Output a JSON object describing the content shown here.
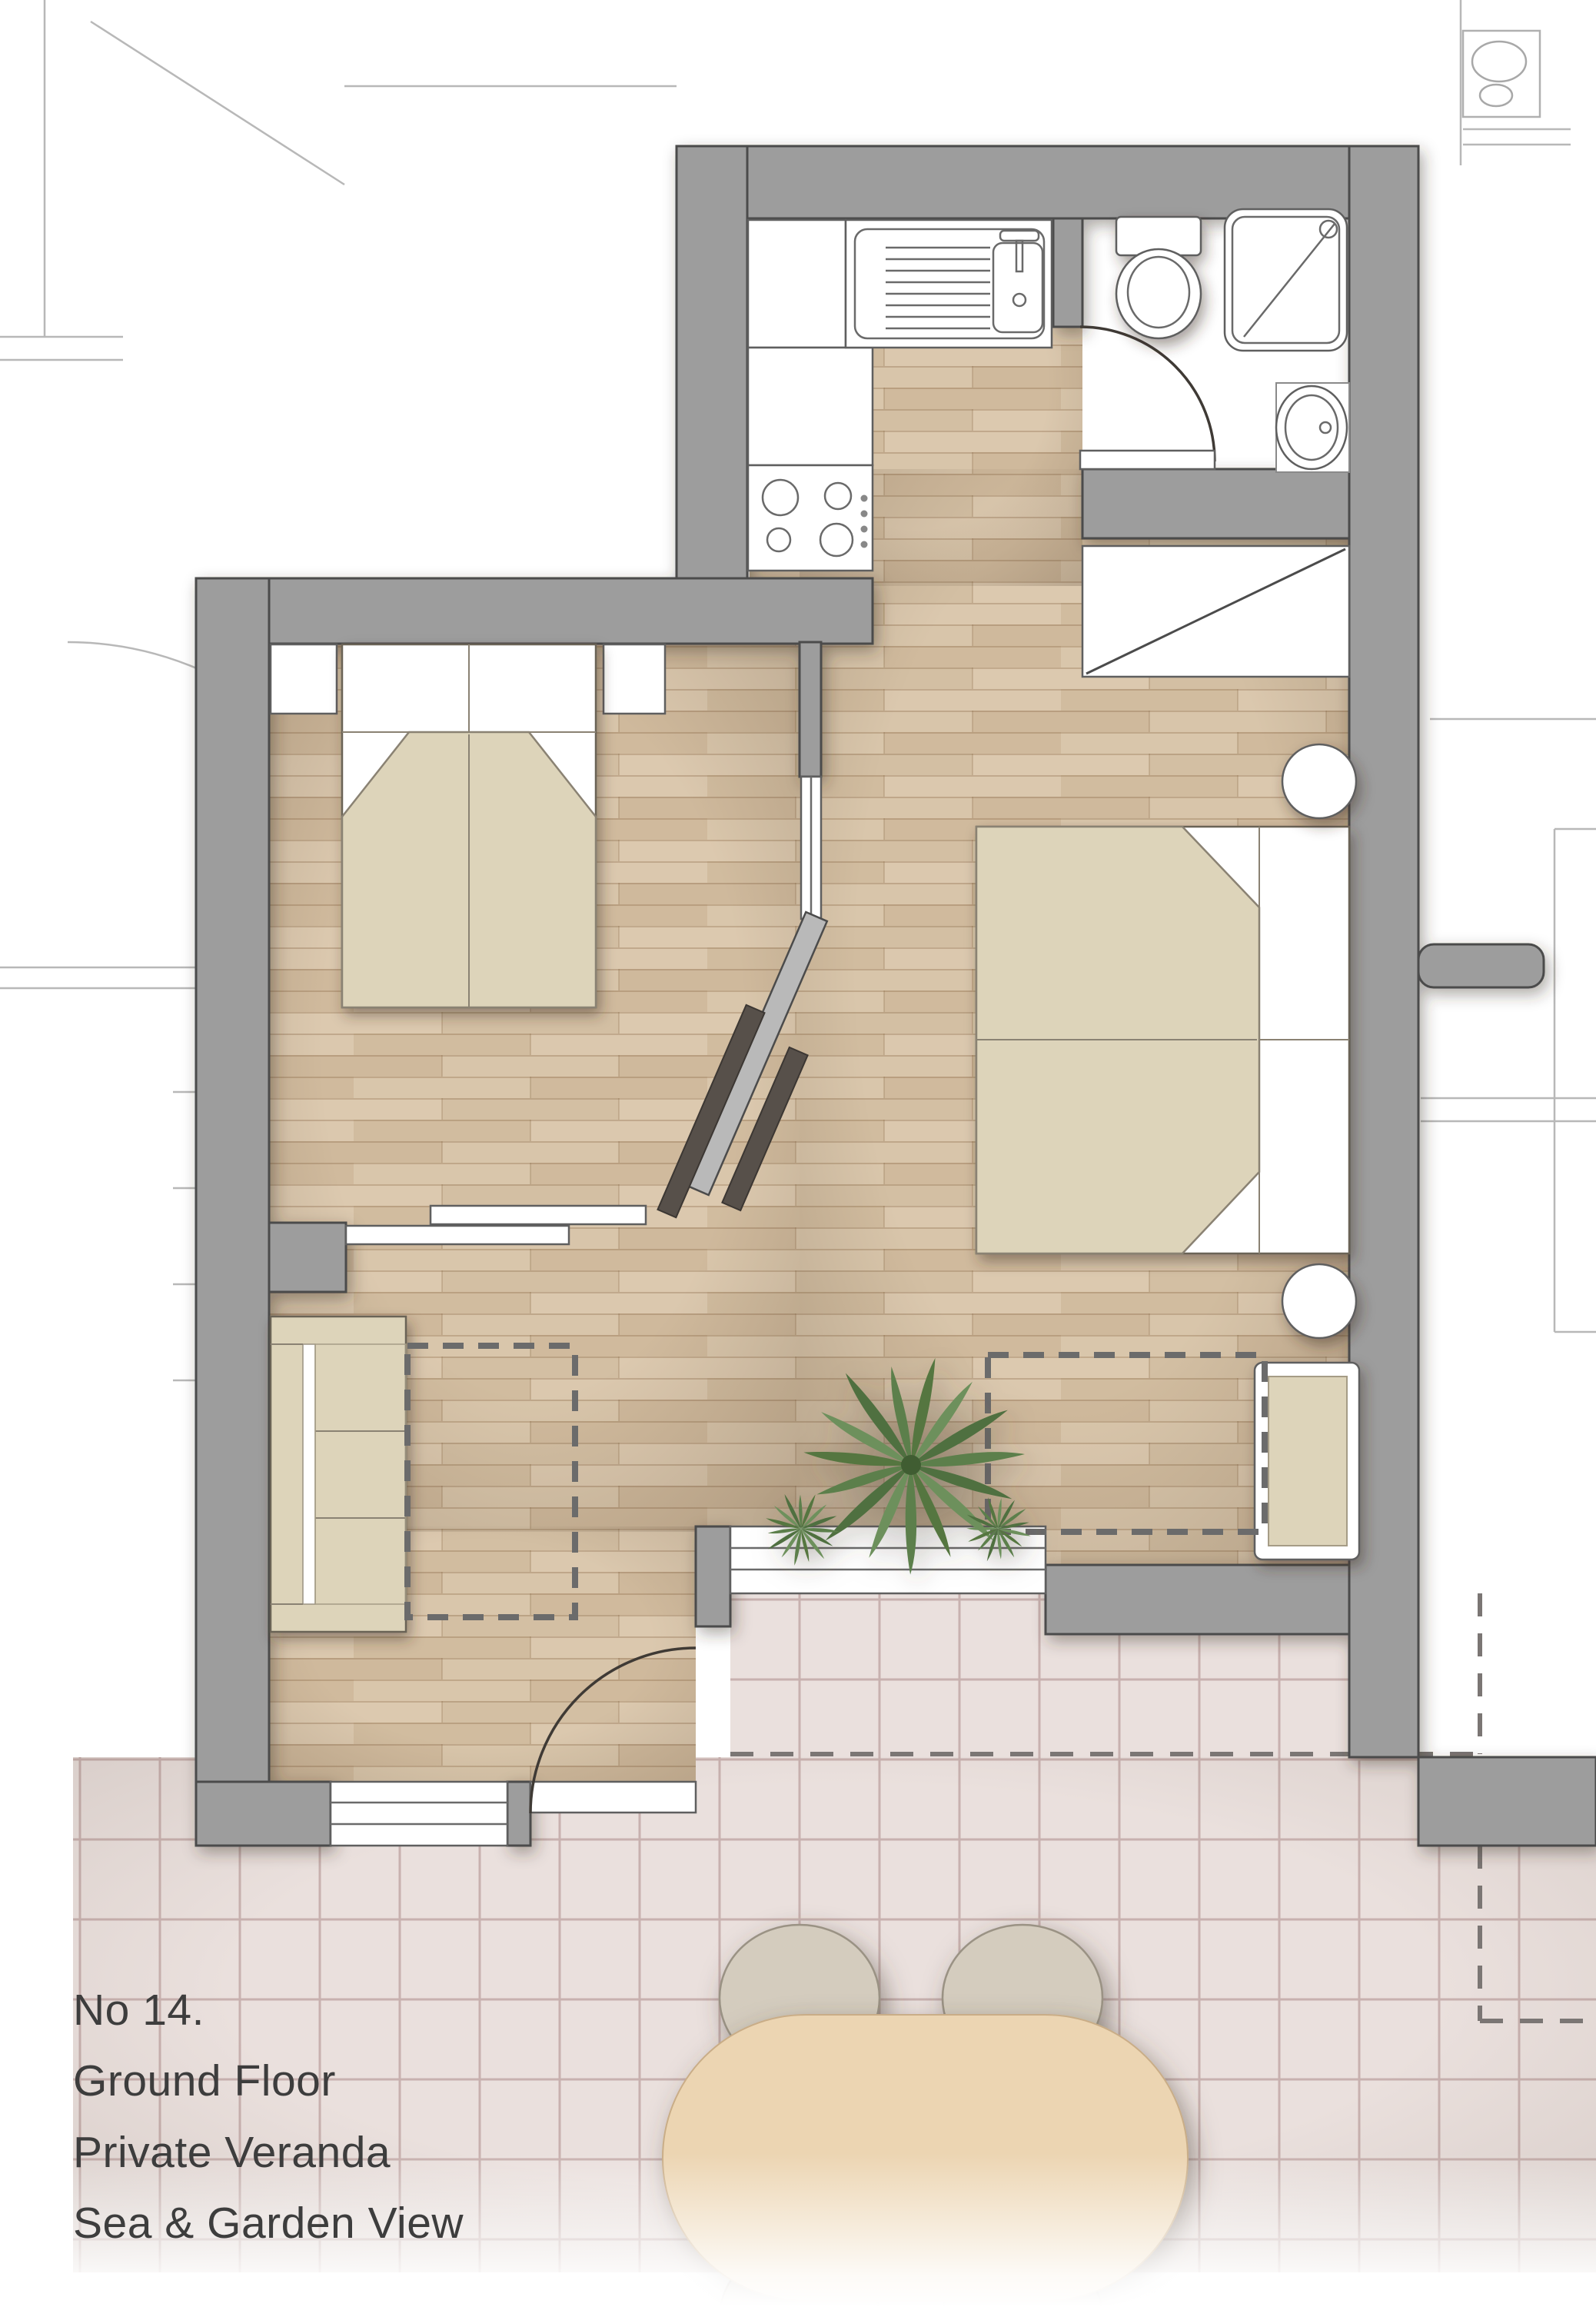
{
  "caption": {
    "lines": [
      "No 14.",
      "Ground Floor",
      "Private Veranda",
      "Sea & Garden View"
    ]
  },
  "colors": {
    "wall_fill": "#9d9d9d",
    "wall_outline": "#4b4b4b",
    "wood_floor": "#d6c2a7",
    "wood_line": "#8a6b47",
    "veranda_tile": "#eae0dd",
    "tile_line": "#c0a8a5",
    "fabric": "#ddd4ba",
    "table_wood": "#ecd5b2",
    "chair_fill": "#d4ccbe",
    "plant_green": "#5c7f4c",
    "text": "#3d3d3d",
    "background": "#ffffff"
  },
  "plan": {
    "drawing_type": "apartment floor plan, top view",
    "depicted_icons": [
      "double-bed-icon",
      "double-bed-icon",
      "sofa-icon",
      "wardrobe-icon",
      "toilet-icon",
      "shower-icon",
      "washbasin-icon",
      "kitchen-sink-icon",
      "cooktop-icon",
      "nightstand-icon",
      "round-stool-icon",
      "bench-icon",
      "dining-table-icon",
      "chair-icon",
      "plant-icon",
      "sliding-door-icon",
      "door-swing-icon",
      "window-icon",
      "dashed-outline-icon"
    ],
    "areas": [
      "kitchen",
      "bathroom",
      "bedroom-left",
      "bedroom-right",
      "living-area",
      "veranda"
    ]
  }
}
